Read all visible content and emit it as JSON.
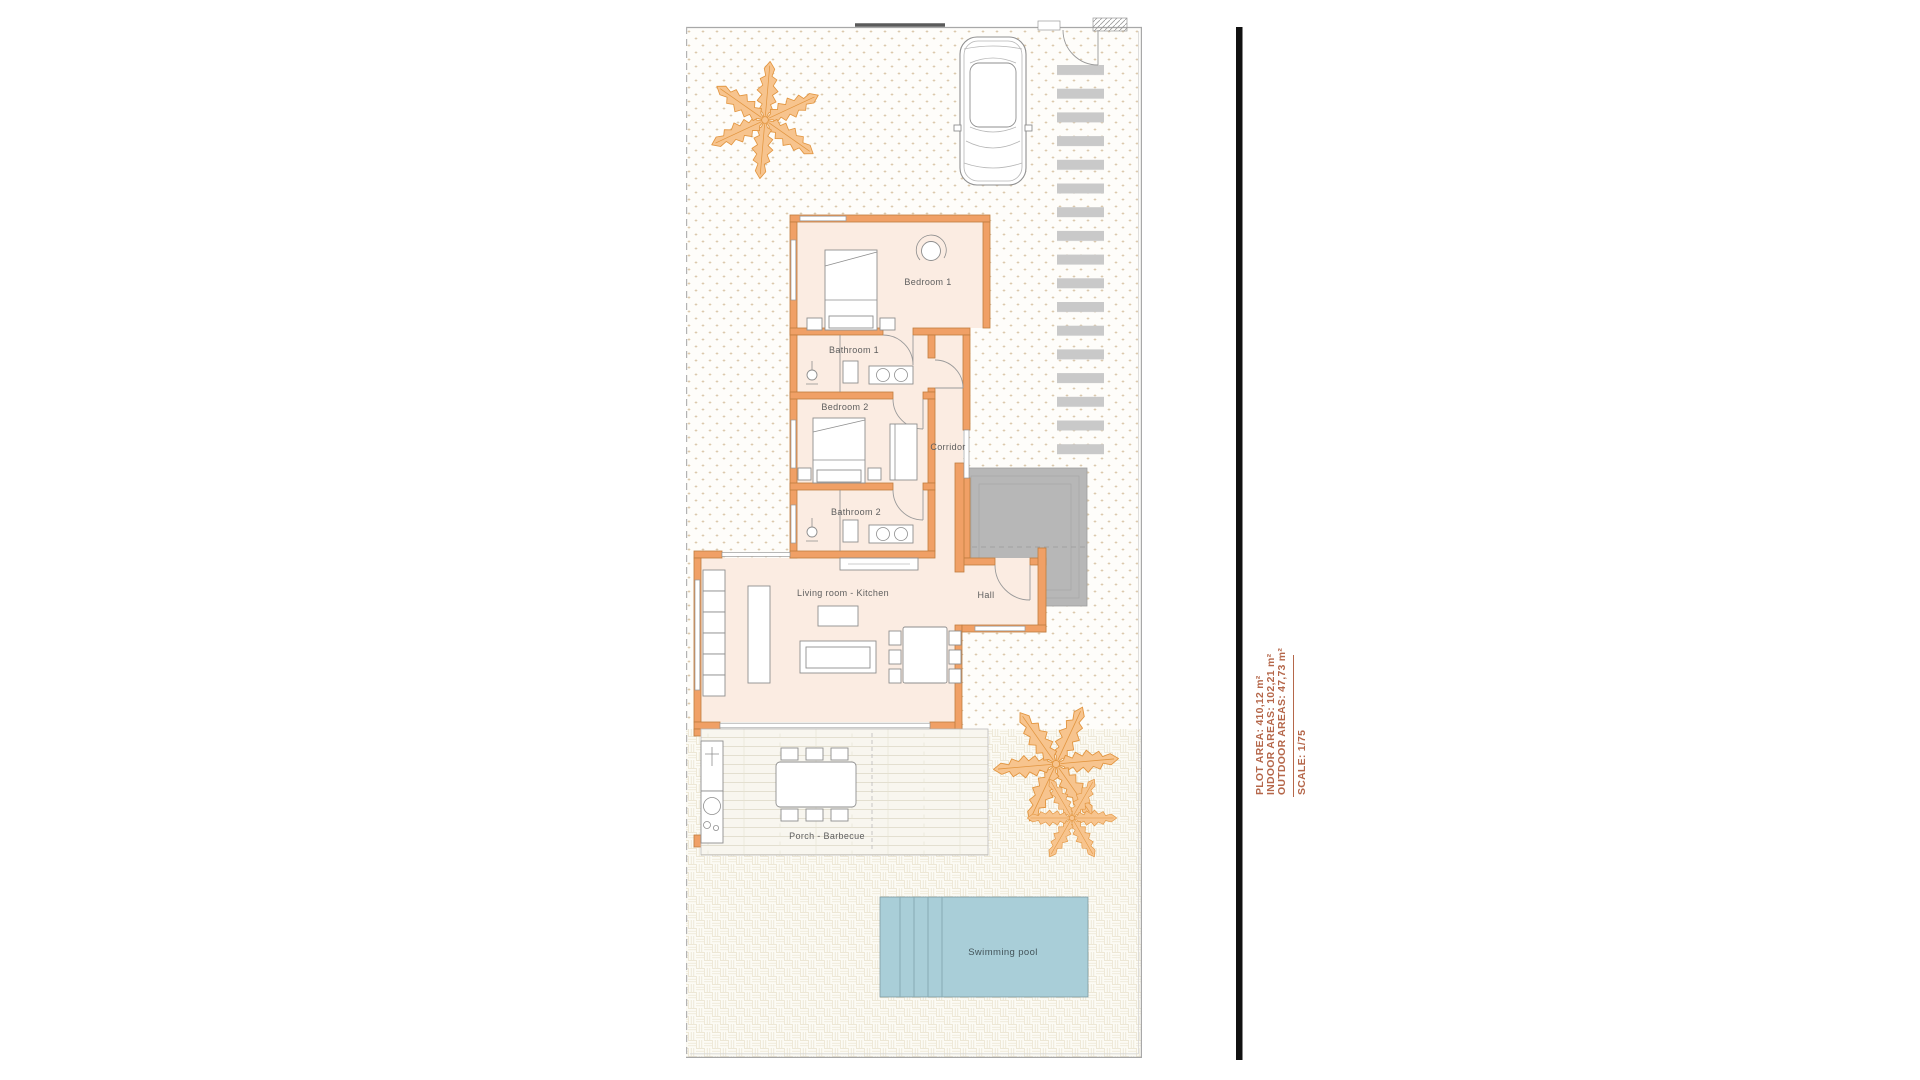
{
  "document": {
    "type": "architectural-floor-plan-villa-with-pool"
  },
  "rooms": {
    "bedroom1": "Bedroom 1",
    "bathroom1": "Bathroom 1",
    "bedroom2": "Bedroom 2",
    "corridor": "Corridor",
    "bathroom2": "Bathroom 2",
    "living_kitchen": "Living room - Kitchen",
    "hall": "Hall",
    "porch": "Porch - Barbecue",
    "pool": "Swimming pool"
  },
  "info_panel": {
    "plot_area": "PLOT AREA: 410,12 m²",
    "indoor_areas": "INDOOR AREAS: 102,21 m²",
    "outdoor_areas": "OUTDOOR AREAS: 47,73 m²",
    "scale": "SCALE: 1/75"
  },
  "colors": {
    "wall": "#f0a066",
    "wall_outline": "#c07c3e",
    "room_floor": "#fbece2",
    "pool_water": "#a9ced8",
    "terrace_gray": "#b7b7b7",
    "path_stripe": "#c9c9c9",
    "palm_orange": "#e2953f",
    "info_text": "#b5674a",
    "divider_bar": "#111111",
    "label_text": "#5e5e5e"
  }
}
